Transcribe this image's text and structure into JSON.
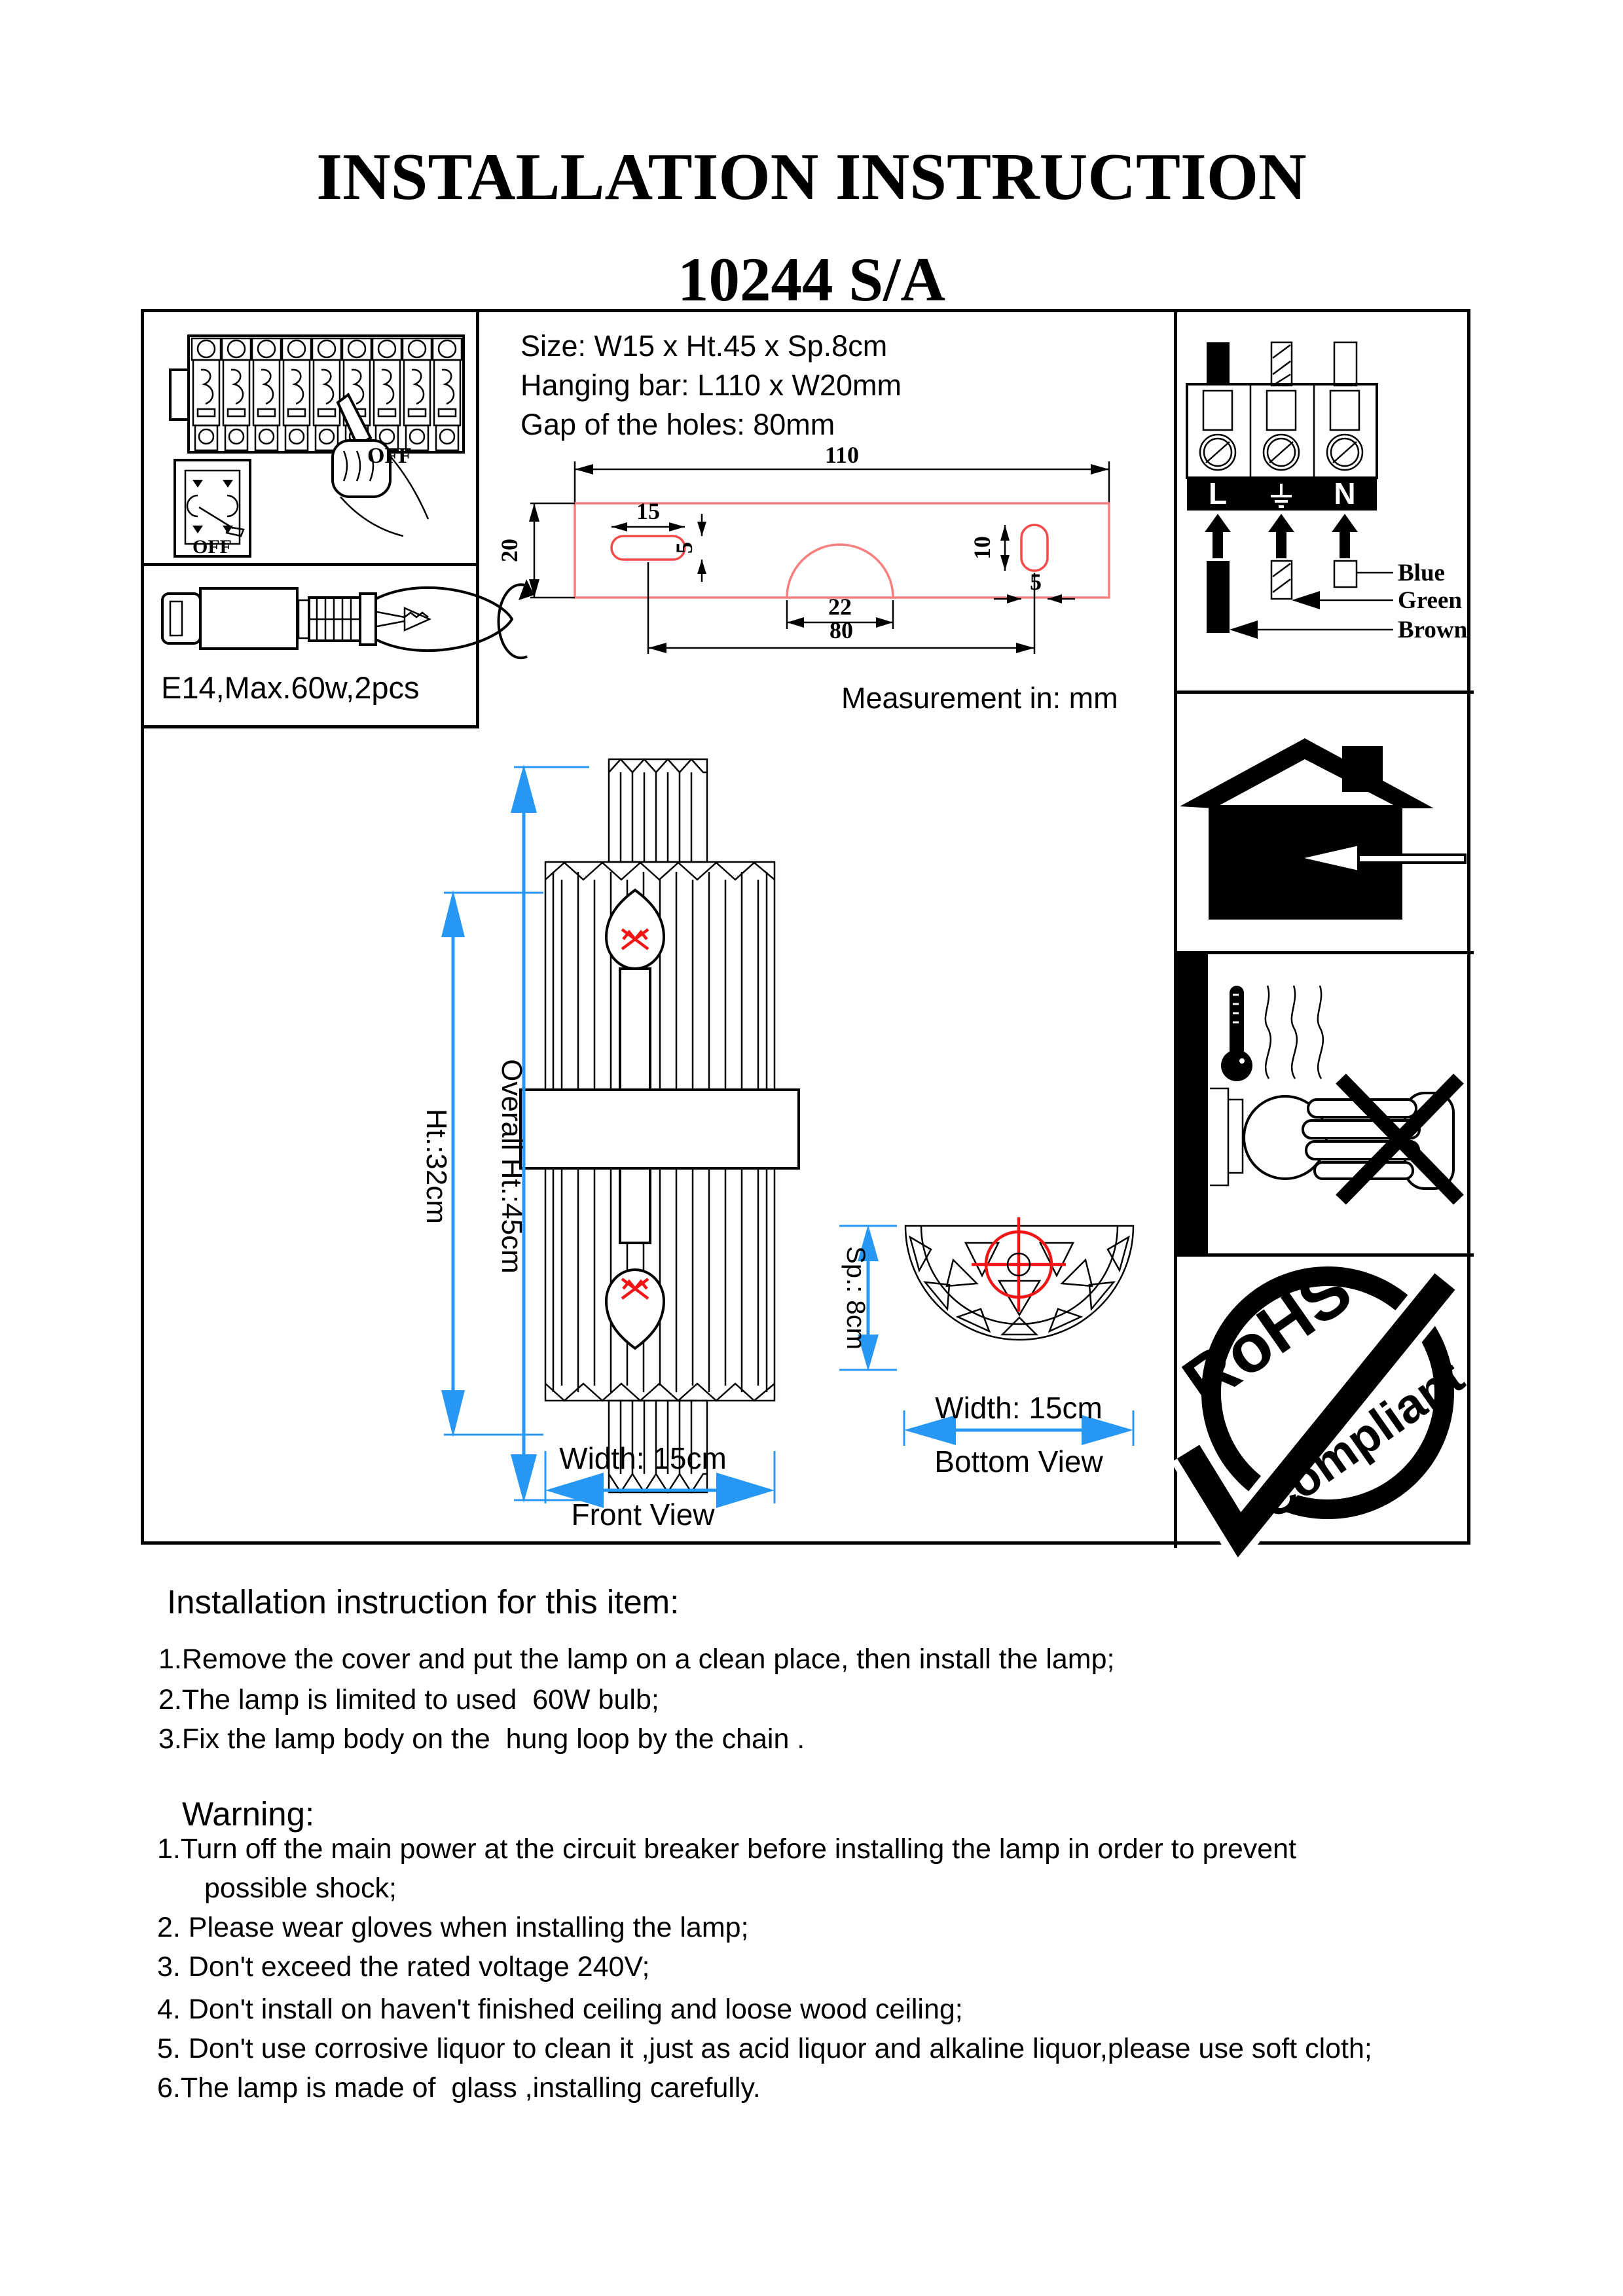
{
  "title": "INSTALLATION INSTRUCTION",
  "model": "10244 S/A",
  "specs": {
    "size": "Size: W15 x Ht.45 x Sp.8cm",
    "hanging_bar": "Hanging bar: L110 x W20mm",
    "gap": "Gap of the holes: 80mm",
    "measurement_note": "Measurement in: mm"
  },
  "breaker_panel": {
    "off_label": "OFF",
    "switch_off_label": "OFF"
  },
  "bulb_spec": "E14,Max.60w,2pcs",
  "bar_dims": {
    "length": "110",
    "height": "20",
    "slot_width": "15",
    "slot_height": "5",
    "notch_width": "22",
    "right_slot_height": "10",
    "right_slot_width": "5",
    "hole_gap": "80"
  },
  "front_view": {
    "overall_height": "Overall Ht.:45cm",
    "body_height": "Ht.:32cm",
    "width": "Width: 15cm",
    "caption": "Front View"
  },
  "bottom_view": {
    "depth": "Sp.: 8cm",
    "width": "Width: 15cm",
    "caption": "Bottom View"
  },
  "wiring": {
    "live": "L",
    "neutral": "N",
    "wire_labels": [
      "Blue",
      "Green",
      "Brown"
    ]
  },
  "rohs": {
    "word1": "RoHS",
    "word2": "Compliant"
  },
  "instructions": {
    "heading": "Installation instruction for this item:",
    "items": [
      "1.Remove the cover and put the lamp on a clean place, then install the lamp;",
      "2.The lamp is limited to used  60W bulb;",
      "3.Fix the lamp body on the  hung loop by the chain ."
    ]
  },
  "warning": {
    "heading": "Warning:",
    "lines": [
      "1.Turn off the main power at the circuit breaker before installing the lamp in order to prevent",
      "possible shock;",
      "2. Please wear gloves when installing the lamp;",
      "3. Don't exceed the rated voltage 240V;",
      "4. Don't install on haven't finished ceiling and loose wood ceiling;",
      "5. Don't use corrosive liquor to clean it ,just as acid liquor and alkaline liquor,please use soft cloth;",
      "6.The lamp is made of  glass ,installing carefully."
    ]
  },
  "colors": {
    "dimension_blue": "#2797f4",
    "bar_red": "#f97e7e",
    "slot_red": "#f44a4a",
    "accent_red": "#f21515"
  }
}
